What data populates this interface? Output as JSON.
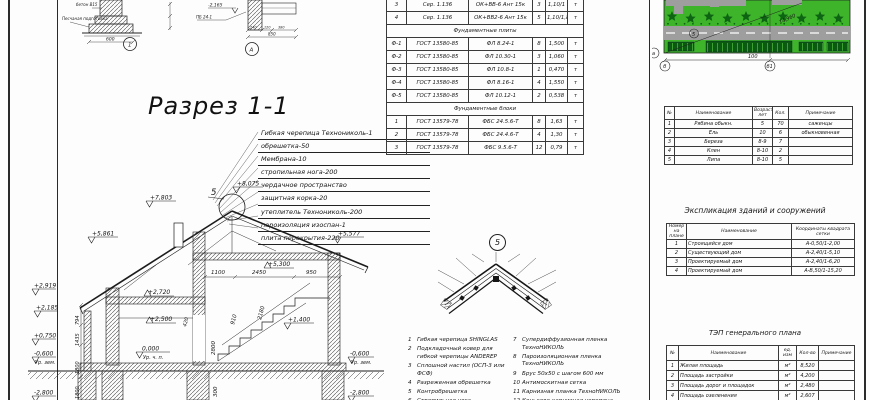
{
  "colors": {
    "lawn": "#3eb42b",
    "tree": "#0d6412",
    "road": "#9e9e9e",
    "parking": "#0b5a11",
    "stripe": "#53bd41"
  },
  "title": {
    "section": "Разрез 1-1"
  },
  "details": {
    "node1": {
      "bubble": "1",
      "dim": "600",
      "label_concrete": "бетон В15",
      "label_sand": "Песчаная подготовка"
    },
    "nodeA": {
      "bubble": "А",
      "elev": "-2,165",
      "label": "ПБ 24-1",
      "d1": "240",
      "d2": "120",
      "d3": "380",
      "total": "850"
    }
  },
  "roof_callout": [
    "Гибкая черепица Технониколь-1",
    "обрешетка-50",
    "Мембрана-10",
    "стропильная нога-200",
    "чердачное пространство",
    "защитная корка-20",
    "утеплитель Технониколь-200",
    "пароизоляция изоспан-1",
    "плита перекрытия-220"
  ],
  "section": {
    "bubble5": "5",
    "marks": {
      "m7803": "+7,803",
      "m8075": "+8,075",
      "m5861": "+5,861",
      "m5577": "+5,577",
      "m5300": "+5,300",
      "m2919": "+2,919",
      "m2720": "+2,720",
      "m2500": "+2,500",
      "m2185": "+2,185",
      "m0750": "+0,750",
      "m1400": "+1,400",
      "m0000": "0,000",
      "urchp": "Ур. ч. п.",
      "m0600l": "-0,600",
      "urzeml": "Ур. зем.",
      "m2800l": "-2,800",
      "m0600r": "-0,600",
      "urzemr": "Ур. зем.",
      "m2800r": "-2,800"
    },
    "dims": {
      "d1100": "1100",
      "d2450": "2450",
      "d950": "950",
      "d910": "910",
      "d2180": "2180",
      "d420": "420",
      "d2800": "2800",
      "d300": "300",
      "d794": "794",
      "d1435": "1435",
      "d1800a": "1800",
      "d1800b": "1800"
    }
  },
  "node5": {
    "bubble": "5",
    "items_left": [
      "Гибкая черепица SHINGLAS",
      "Подкладочный ковер для гибкой черепицы ANDEREP",
      "Сплошной настил (ОСП-3 или ФСФ)",
      "Разреженная обрешетка",
      "Контробрешетка",
      "Стропильная нога"
    ],
    "items_right": [
      "Супердиффузионная пленка ТехноНИКОЛЬ",
      "Пароизоляционная пленка ТехноНИКОЛЬ",
      "Брус 50х50 с шагом 600 мм",
      "Антимоскитная сетка",
      "Карнизная планка ТехноНИКОЛЬ",
      "Коньково-карнизная черепица",
      "Брус 50х50 длиной 550 мм"
    ]
  },
  "site_plan": {
    "tree_count": 10,
    "shrub_count": 22,
    "road_label": "14,960",
    "dim_label": "100",
    "axis_left": "а",
    "axis_b": "б",
    "axis_b1": "б1",
    "marker": "5"
  },
  "panel": {
    "explication_title": "Экспликация зданий и сооружений",
    "tep_title": "ТЭП генерального плана"
  },
  "tables": {
    "spec": {
      "rows": [
        {
          "c": [
            "3",
            "Сер. 1.136",
            "ОК+ВВ-6 Ант 15к",
            "3",
            "1,10/1",
            "т"
          ]
        },
        {
          "c": [
            "4",
            "Сер. 1.136",
            "ОК+ВВ2-6 Ант 15к",
            "5",
            "1,10/1,8",
            "т"
          ]
        },
        {
          "merged": "Фундаментные плиты"
        },
        {
          "c": [
            "Ф-1",
            "ГОСТ 13580-85",
            "ФЛ 8.24-1",
            "8",
            "1,500",
            "т"
          ]
        },
        {
          "c": [
            "Ф-2",
            "ГОСТ 13580-85",
            "ФЛ 10.30-1",
            "3",
            "1,060",
            "т"
          ]
        },
        {
          "c": [
            "Ф-3",
            "ГОСТ 13580-85",
            "ФЛ 10.8-1",
            "1",
            "0,470",
            "т"
          ]
        },
        {
          "c": [
            "Ф-4",
            "ГОСТ 13580-85",
            "ФЛ 8.16-1",
            "4",
            "1,550",
            "т"
          ]
        },
        {
          "c": [
            "Ф-5",
            "ГОСТ 13580-85",
            "ФЛ 10.12-1",
            "2",
            "0,538",
            "т"
          ]
        },
        {
          "merged": "Фундаментные блоки"
        },
        {
          "c": [
            "1",
            "ГОСТ 13579-78",
            "ФБС 24.5.6-Т",
            "8",
            "1,63",
            "т"
          ]
        },
        {
          "c": [
            "2",
            "ГОСТ 13579-78",
            "ФБС 24.4.6-Т",
            "4",
            "1,30",
            "т"
          ]
        },
        {
          "c": [
            "3",
            "ГОСТ 13579-78",
            "ФБС 9.5.6-Т",
            "12",
            "0,79",
            "т"
          ]
        }
      ]
    },
    "trees": {
      "headers": [
        "№",
        "Наименование",
        "Возраст, лет",
        "Кол.",
        "Примечание"
      ],
      "rows": [
        {
          "c": [
            "1",
            "Рябина обыкн.",
            "5",
            "70",
            "саженцы"
          ]
        },
        {
          "c": [
            "2",
            "Ель",
            "10",
            "6",
            "обыкновенная"
          ]
        },
        {
          "c": [
            "3",
            "Береза",
            "8-9",
            "7",
            ""
          ]
        },
        {
          "c": [
            "4",
            "Клен",
            "8-10",
            "2",
            ""
          ]
        },
        {
          "c": [
            "5",
            "Липа",
            "8-10",
            "5",
            ""
          ]
        }
      ]
    },
    "explication": {
      "headers": [
        "Номер на плане",
        "Наименование",
        "Координаты квадрата сетки"
      ],
      "rows": [
        {
          "c": [
            "1",
            "Строящийся дом",
            "А-0,50/1-2,00"
          ]
        },
        {
          "c": [
            "2",
            "Существующий дом",
            "А-2,40/1-5,10"
          ]
        },
        {
          "c": [
            "3",
            "Проектируемый дом",
            "А-2,40/1-6,20"
          ]
        },
        {
          "c": [
            "4",
            "Проектируемый дом",
            "А-В,50/1-15,20"
          ]
        }
      ]
    },
    "tep": {
      "headers": [
        "№",
        "Наименование",
        "ед. изм",
        "Кол-во",
        "Примечание"
      ],
      "rows": [
        {
          "c": [
            "1",
            "Жилая площадь",
            "м²",
            "8,520",
            ""
          ]
        },
        {
          "c": [
            "2",
            "Площадь застройки",
            "м²",
            "4,200",
            ""
          ]
        },
        {
          "c": [
            "3",
            "Площадь дорог и площадок",
            "м²",
            "2,480",
            ""
          ]
        },
        {
          "c": [
            "4",
            "Площадь озеленения",
            "м²",
            "2,607",
            ""
          ]
        }
      ]
    }
  }
}
